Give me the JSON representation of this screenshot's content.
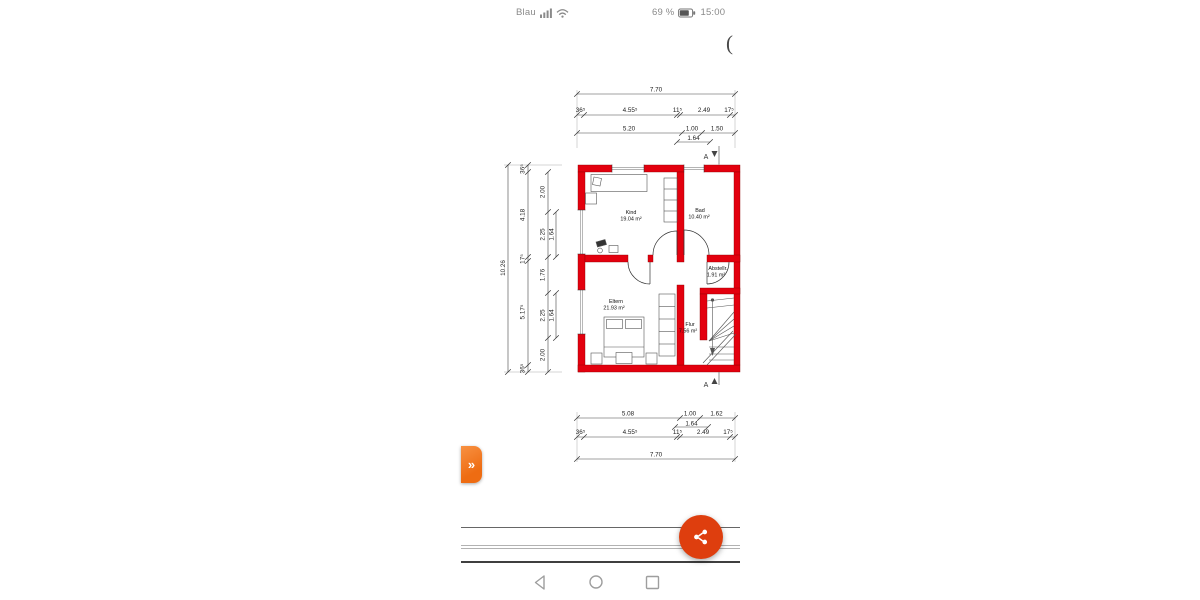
{
  "status_bar": {
    "carrier": "Blau",
    "battery_text": "69 %",
    "time": "15:00",
    "signal_icon": "signal-bars",
    "wifi_icon": "wifi",
    "battery_icon": "battery-two-thirds"
  },
  "viewer": {
    "cut_text": "("
  },
  "plan": {
    "rooms": [
      {
        "name": "Kind",
        "area": "19.04 m²"
      },
      {
        "name": "Bad",
        "area": "10.40 m²"
      },
      {
        "name": "Abstellr.",
        "area": "1.91 m²"
      },
      {
        "name": "Eltern",
        "area": "21.93 m²"
      },
      {
        "name": "Flur",
        "area": "7.56 m²"
      }
    ],
    "section_label": "A",
    "dims": {
      "top": {
        "total": "7.70",
        "outer": [
          "36⁵",
          "4.55⁵",
          "11⁵",
          "2.49",
          "17⁵"
        ],
        "inner": [
          "5.20",
          "1.00",
          "1.50"
        ],
        "sub": "1.64"
      },
      "bottom": {
        "total": "7.70",
        "outer": [
          "36⁵",
          "4.55⁵",
          "11⁵",
          "2.49",
          "17⁵"
        ],
        "inner": [
          "5.08",
          "1.00",
          "1.62"
        ],
        "sub": "1.64"
      },
      "left": {
        "total": "10.26",
        "outer": [
          "36⁵",
          "4.18",
          "17⁵",
          "5.17⁵",
          "36⁵"
        ],
        "inner": [
          "2.00",
          "2.25",
          "1.76",
          "2.25",
          "2.00"
        ],
        "sub": "1.64"
      }
    }
  },
  "controls": {
    "expand_tab_glyph": "»",
    "expand_tab_icon": "double-chevron-right",
    "share_icon": "share"
  },
  "nav_bar": {
    "back_icon": "back-triangle",
    "home_icon": "home-circle",
    "recents_icon": "recents-square"
  },
  "colors": {
    "wall_red": "#e3000e",
    "tab_orange": "#ee6c12",
    "fab_orange": "#de3e0e"
  }
}
